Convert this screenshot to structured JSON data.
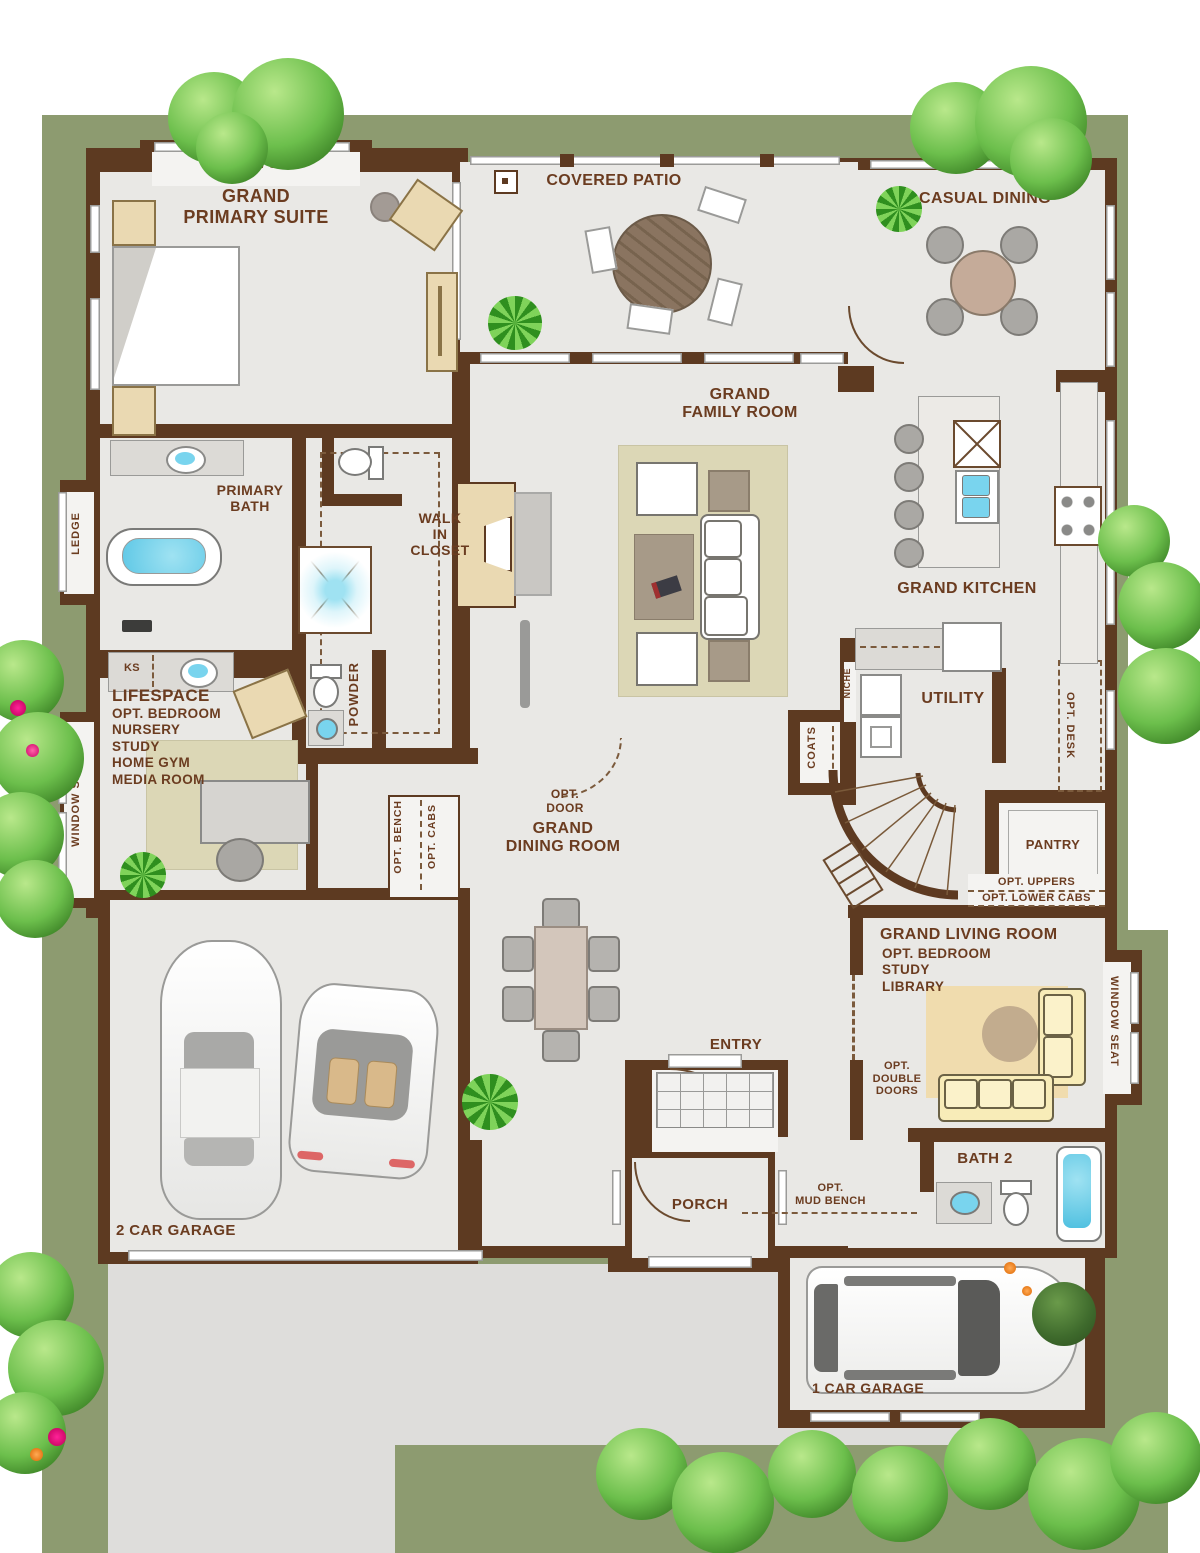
{
  "colors": {
    "wall": "#5d3a21",
    "label_ink": "#6b3c20",
    "floor": "#e9e8e5",
    "yard_green": "#8d9b70",
    "driveway": "#dedddb",
    "rug_beige": "#dcd7b6",
    "furniture_tan": "#ead9b2",
    "sofa_yellow": "#f8ecb8",
    "water_blue": "#79d4ee",
    "tree_green": "#6cbf4c"
  },
  "plan": {
    "suite": {
      "seat": "WINDOW SEAT",
      "t1": "GRAND",
      "t2": "PRIMARY SUITE"
    },
    "patio": {
      "title": "COVERED PATIO"
    },
    "casual": {
      "title": "CASUAL DINING"
    },
    "family": {
      "t1": "GRAND",
      "t2": "FAMILY ROOM"
    },
    "pbath": {
      "t1": "PRIMARY",
      "t2": "BATH",
      "ledge": "LEDGE",
      "ks": "KS"
    },
    "wic": {
      "t1": "WALK",
      "t2": "IN",
      "t3": "CLOSET"
    },
    "lifespace": {
      "title": "LIFESPACE",
      "opts": [
        "OPT. BEDROOM",
        "NURSERY",
        "STUDY",
        "HOME GYM",
        "MEDIA ROOM"
      ],
      "seat": "WINDOW SEAT",
      "door1": "OPT.",
      "door2": "DOOR"
    },
    "powder": {
      "title": "POWDER"
    },
    "kitchen": {
      "title": "GRAND KITCHEN",
      "desk": "OPT. DESK"
    },
    "utility": {
      "title": "UTILITY",
      "niche": "NICHE",
      "coats": "COATS"
    },
    "pantry": {
      "title": "PANTRY",
      "uppers": "OPT. UPPERS",
      "lower": "OPT. LOWER CABS"
    },
    "living": {
      "title": "GRAND LIVING ROOM",
      "opts": [
        "OPT. BEDROOM",
        "STUDY",
        "LIBRARY"
      ],
      "dd1": "OPT.",
      "dd2": "DOUBLE",
      "dd3": "DOORS",
      "seat": "WINDOW SEAT"
    },
    "dining": {
      "t1": "GRAND",
      "t2": "DINING ROOM",
      "bench": "OPT. BENCH",
      "cabs": "OPT. CABS"
    },
    "entry": {
      "title": "ENTRY"
    },
    "porch": {
      "title": "PORCH"
    },
    "mud": {
      "l1": "OPT.",
      "l2": "MUD BENCH"
    },
    "bath2": {
      "title": "BATH 2"
    },
    "garage2": {
      "title": "2 CAR GARAGE"
    },
    "garage1": {
      "title": "1 CAR GARAGE"
    }
  }
}
